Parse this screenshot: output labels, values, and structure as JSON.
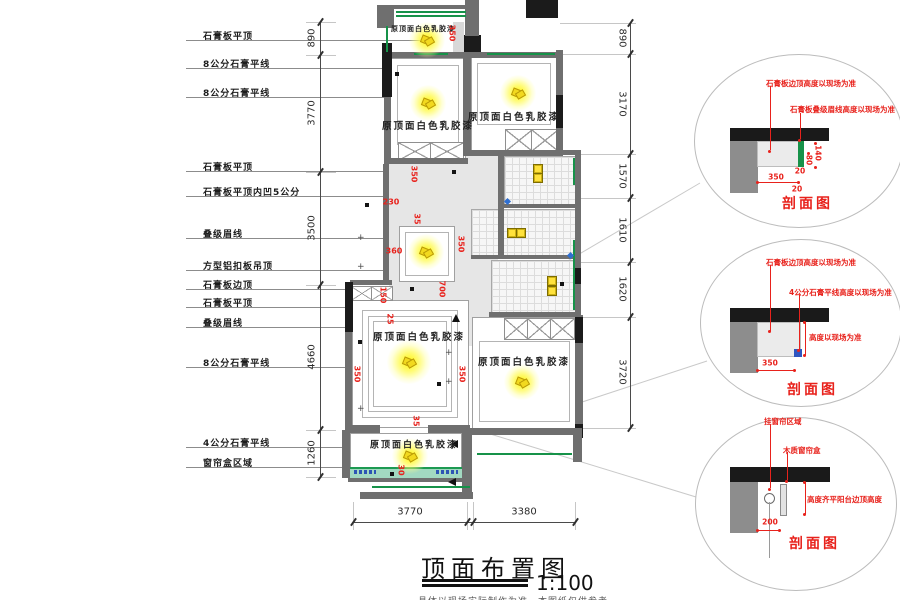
{
  "title": {
    "text": "顶面布置图",
    "scale": "1:100",
    "note": "具体以现场实际制作为准，本图纸仅供参考"
  },
  "labels_left": [
    "石膏板平顶",
    "8公分石膏平线",
    "8公分石膏平线",
    "石膏板平顶",
    "石膏板平顶内凹5公分",
    "叠级眉线",
    "方型铝扣板吊顶",
    "石膏板边顶",
    "石膏板平顶",
    "叠级眉线",
    "8公分石膏平线",
    "4公分石膏平线",
    "窗帘盒区域"
  ],
  "dims": {
    "left": {
      "values": [
        "890",
        "3770",
        "3500",
        "4660",
        "1260"
      ]
    },
    "right": {
      "values": [
        "890",
        "3170",
        "1570",
        "1610",
        "1620",
        "3720"
      ]
    },
    "bottom": {
      "values": [
        "3770",
        "3380"
      ]
    }
  },
  "plan": {
    "paint_label": "原顶面白色乳胶漆",
    "red_dims": [
      "350",
      "350",
      "230",
      "35",
      "360",
      "350",
      "700",
      "150",
      "25",
      "350",
      "350",
      "35",
      "30"
    ]
  },
  "details": [
    {
      "caption": "剖面图",
      "labels": [
        "石膏板边顶高度以现场为准",
        "石膏板叠级眉线高度以现场为准"
      ],
      "dims": [
        "140",
        "80",
        "20",
        "350",
        "20"
      ]
    },
    {
      "caption": "剖面图",
      "labels": [
        "石膏板边顶高度以现场为准",
        "4公分石膏平线高度以现场为准",
        "高度以现场为准"
      ],
      "dims": [
        "350"
      ]
    },
    {
      "caption": "剖面图",
      "labels": [
        "挂窗帘区域",
        "木质窗帘盒",
        "高度齐平阳台边顶高度"
      ],
      "dims": [
        "200"
      ]
    }
  ],
  "colors": {
    "wall": "#6f6f6f",
    "wall_dark": "#1b1b1b",
    "curtain_green": "#169249",
    "red_annotation": "#e8221c",
    "light_yellow": "#fff400",
    "teal_strip": "#a2d9c1"
  }
}
